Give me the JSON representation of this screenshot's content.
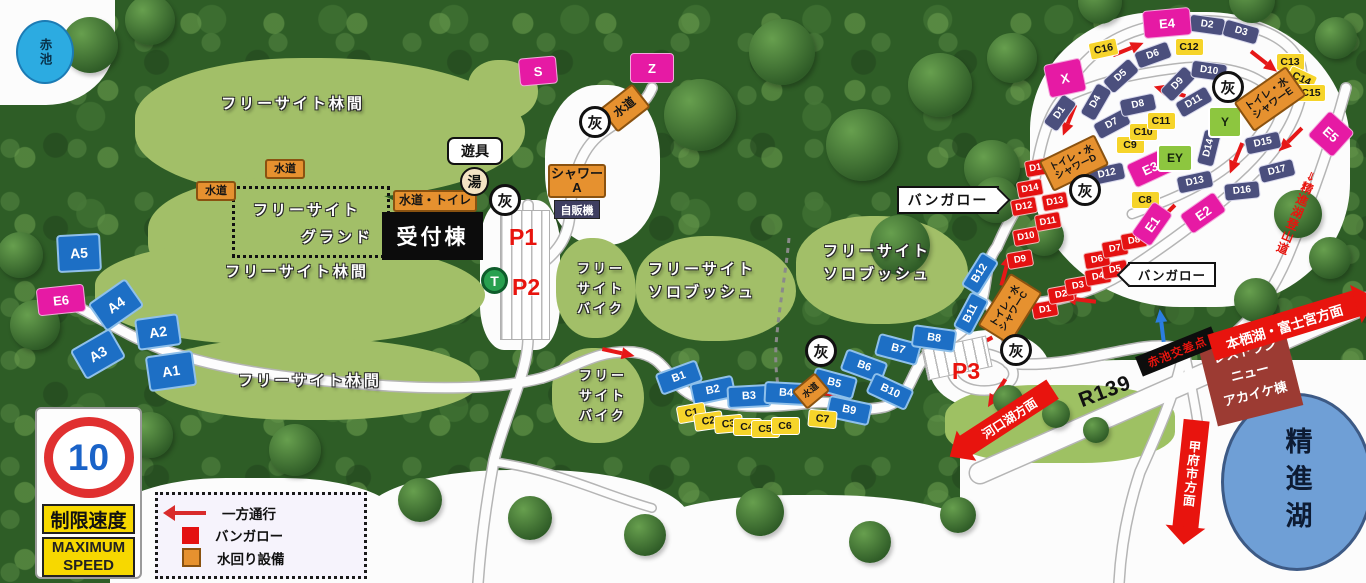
{
  "title": "キャンプ場マップ",
  "texts": {
    "reception": "受付棟",
    "playground": "遊具",
    "bath": "湯",
    "vending": "自販機",
    "p1": "P1",
    "p2": "P2",
    "p3": "P3",
    "t_pin": "T",
    "bungalow_pointer_right": "バンガロー",
    "bungalow_pointer_left": "バンガロー",
    "akaike_pond": "赤池",
    "shoji_lake": "精進湖",
    "intersection": "赤池交差点",
    "restaurant": [
      "レストラン",
      "ニュー",
      "アカイケ棟"
    ],
    "motosu_arrow": "本栖湖・富士宮方面",
    "kawaguchi_arrow": "河口湖方面",
    "kofu_arrow": "甲府市方面",
    "r139": "R139",
    "tozando": "⇒精進湖登山道",
    "grand_line1": "フリーサイト",
    "grand_line2": "グランド"
  },
  "legend": {
    "rows": [
      {
        "icon": "one-way-arrow",
        "label": "一方通行"
      },
      {
        "icon": "bungalow-square",
        "label": "バンガロー"
      },
      {
        "icon": "water-square",
        "label": "水回り設備"
      }
    ]
  },
  "speed_sign": {
    "number": "10",
    "jp": "制限速度",
    "en1": "MAXIMUM",
    "en2": "SPEED"
  },
  "colors": {
    "site_blue": "#1d6fc5",
    "site_navy": "#4b4f7d",
    "site_yellow": "#f6d42a",
    "bungalow_red": "#e41111",
    "site_magenta": "#e61aa4",
    "site_green": "#8dc63f",
    "water_orange": "#e6912f",
    "arrow_red": "#e61717",
    "arrow_blue": "#2b7de0",
    "forest_dark": "#2e5d26",
    "clearing_green": "#a2bf68",
    "lake_blue": "#6f9fd6",
    "pond_blue": "#2cabe1"
  },
  "map": {
    "ash_label": "灰",
    "clearings": [
      [
        1030,
        12,
        320,
        295,
        "#fcfcfc",
        "40% 45% 42% 47%"
      ],
      [
        930,
        330,
        120,
        80,
        "#fcfcfc",
        "50%"
      ],
      [
        480,
        200,
        80,
        150,
        "#fcfcfc",
        "30%"
      ],
      [
        545,
        85,
        115,
        160,
        "#fcfcfc",
        "45%"
      ],
      [
        0,
        0,
        115,
        105,
        "#fcfcfc",
        "0 0 60% 0"
      ],
      [
        110,
        478,
        290,
        105,
        "#fcfcfc",
        "40% 40% 0 0"
      ],
      [
        360,
        470,
        330,
        113,
        "#fcfcfc",
        "45% 45% 0 0"
      ],
      [
        640,
        495,
        340,
        88,
        "#fcfcfc",
        "45% 45% 0 0"
      ],
      [
        960,
        360,
        406,
        223,
        "#fcfcfc",
        "40% 0 0 0"
      ],
      [
        135,
        58,
        390,
        140,
        null,
        null
      ],
      [
        148,
        178,
        280,
        120,
        null,
        null
      ],
      [
        95,
        240,
        390,
        105,
        null,
        null
      ],
      [
        150,
        338,
        330,
        82,
        null,
        null
      ],
      [
        556,
        238,
        80,
        100,
        null,
        null
      ],
      [
        552,
        348,
        92,
        95,
        null,
        null
      ],
      [
        636,
        236,
        160,
        105,
        null,
        null
      ],
      [
        796,
        216,
        172,
        108,
        null,
        null
      ],
      [
        468,
        60,
        70,
        60,
        null,
        null
      ],
      [
        945,
        385,
        230,
        78,
        "#9ec163",
        "40%"
      ]
    ],
    "trees": [
      [
        90,
        45,
        56
      ],
      [
        150,
        20,
        50
      ],
      [
        20,
        255,
        46
      ],
      [
        35,
        325,
        50
      ],
      [
        150,
        435,
        46
      ],
      [
        295,
        450,
        52
      ],
      [
        420,
        500,
        44
      ],
      [
        530,
        518,
        44
      ],
      [
        645,
        535,
        42
      ],
      [
        760,
        512,
        48
      ],
      [
        870,
        542,
        42
      ],
      [
        958,
        515,
        36
      ],
      [
        700,
        115,
        72
      ],
      [
        782,
        52,
        66
      ],
      [
        862,
        145,
        72
      ],
      [
        940,
        85,
        64
      ],
      [
        992,
        168,
        56
      ],
      [
        900,
        245,
        60
      ],
      [
        1012,
        58,
        50
      ],
      [
        996,
        200,
        46
      ],
      [
        1044,
        236,
        40
      ],
      [
        1298,
        214,
        48
      ],
      [
        1330,
        258,
        42
      ],
      [
        1256,
        300,
        44
      ],
      [
        1100,
        2,
        44
      ],
      [
        1252,
        0,
        46
      ],
      [
        1336,
        38,
        42
      ],
      [
        1008,
        400,
        30
      ],
      [
        1056,
        414,
        28
      ],
      [
        1096,
        430,
        26
      ]
    ],
    "roads": [
      {
        "d": "M 48,295 C 90,308 120,335 170,352 C 230,372 300,380 390,386 C 440,389 500,389 542,378",
        "w": 9
      },
      {
        "d": "M 542,378 C 575,368 595,350 632,352 C 672,355 665,390 705,400 C 745,409 775,407 810,403 C 845,399 852,414 884,407 C 916,399 908,362 938,347 C 962,334 974,322 981,303 C 988,283 984,263 997,247",
        "w": 9
      },
      {
        "d": "M 528,205 L 528,338 C 528,372 505,415 494,460 C 487,498 481,540 478,583",
        "w": 9
      },
      {
        "d": "M 652,88 C 644,108 622,118 602,133 C 578,151 572,182 570,212 C 569,238 556,252 544,262",
        "w": 9
      },
      {
        "d": "M 997,247 C 1008,222 1018,203 1034,187 C 1038,152 1046,118 1062,99 C 1080,52 1124,28 1172,23 C 1232,15 1292,30 1301,68 C 1308,106 1282,148 1243,183 C 1203,219 1162,248 1122,274 C 1092,292 1062,300 1036,303",
        "w": 9
      },
      {
        "d": "M 1062,99 C 1092,84 1132,74 1172,69 C 1212,63 1252,70 1270,89 C 1281,108 1262,138 1232,163 C 1202,188 1162,203 1132,214",
        "w": 8
      },
      {
        "d": "M 938,347 C 962,352 992,349 1008,363 C 1024,379 1002,394 976,390 C 952,386 945,368 958,357",
        "w": 8
      },
      {
        "d": "M 1008,363 C 1052,368 1092,356 1132,349 C 1158,344 1172,346 1184,350 C 1176,392 1158,432 1140,472 C 1128,508 1121,545 1119,583",
        "w": 9
      },
      {
        "d": "M 1184,350 C 1191,382 1196,410 1200,437",
        "w": 8
      },
      {
        "d": "M 1346,88 C 1332,140 1312,198 1287,258 C 1267,304 1243,330 1212,351",
        "w": 9
      },
      {
        "d": "M 980,473 L 1366,303",
        "w": 20
      },
      {
        "d": "M 494,462 C 556,470 602,494 652,508",
        "w": 7
      },
      {
        "d": "M 983,300 C 996,312 1004,330 1008,348",
        "w": 7
      },
      {
        "d": "M 789,238 C 786,272 779,306 776,345 C 775,365 777,383 780,396",
        "w": 3,
        "dash": 1
      }
    ],
    "parking": [
      [
        500,
        210,
        48,
        128,
        0
      ],
      [
        924,
        342,
        64,
        30,
        -12
      ]
    ],
    "arrows": [
      [
        616,
        352,
        12
      ],
      [
        830,
        394,
        4
      ],
      [
        1005,
        272,
        -75
      ],
      [
        980,
        344,
        152
      ],
      [
        998,
        391,
        122
      ],
      [
        1082,
        300,
        187
      ],
      [
        1126,
        50,
        -22
      ],
      [
        1262,
        60,
        38
      ],
      [
        1292,
        138,
        135
      ],
      [
        1172,
        92,
        197
      ],
      [
        1070,
        118,
        112
      ],
      [
        1237,
        156,
        112
      ],
      [
        1165,
        215,
        135
      ],
      [
        1162,
        328,
        -97,
        1
      ]
    ],
    "sites": [
      {
        "id": "A1",
        "t": "A",
        "x": 169,
        "y": 369,
        "r": -8
      },
      {
        "id": "A2",
        "t": "A",
        "x": 156,
        "y": 330,
        "r": -8,
        "w": 40,
        "h": 28
      },
      {
        "id": "A3",
        "t": "A",
        "x": 96,
        "y": 352,
        "r": -30,
        "w": 42,
        "h": 30
      },
      {
        "id": "A4",
        "t": "A",
        "x": 114,
        "y": 303,
        "r": -35,
        "w": 42,
        "h": 30
      },
      {
        "id": "A5",
        "t": "A",
        "x": 77,
        "y": 251,
        "r": -3,
        "w": 40,
        "h": 34
      },
      {
        "id": "E6",
        "t": "M",
        "x": 60,
        "y": 299,
        "r": -6,
        "w": 46,
        "h": 26
      },
      {
        "id": "B1",
        "t": "B",
        "x": 677,
        "y": 375,
        "r": -20
      },
      {
        "id": "B2",
        "t": "B",
        "x": 711,
        "y": 388,
        "r": -12
      },
      {
        "id": "B3",
        "t": "B",
        "x": 747,
        "y": 394,
        "r": -3
      },
      {
        "id": "B4",
        "t": "B",
        "x": 784,
        "y": 391,
        "r": 3
      },
      {
        "id": "B5",
        "t": "B",
        "x": 832,
        "y": 381,
        "r": 15
      },
      {
        "id": "B6",
        "t": "B",
        "x": 862,
        "y": 364,
        "r": 20
      },
      {
        "id": "B7",
        "t": "B",
        "x": 896,
        "y": 347,
        "r": 15
      },
      {
        "id": "B8",
        "t": "B",
        "x": 932,
        "y": 336,
        "r": 8
      },
      {
        "id": "B9",
        "t": "B",
        "x": 847,
        "y": 408,
        "r": 12
      },
      {
        "id": "B10",
        "t": "B",
        "x": 888,
        "y": 389,
        "r": 25
      },
      {
        "id": "B11",
        "t": "B",
        "x": 969,
        "y": 311,
        "r": -62,
        "w": 36,
        "h": 17
      },
      {
        "id": "B12",
        "t": "B",
        "x": 978,
        "y": 271,
        "r": -58,
        "w": 36,
        "h": 17
      },
      {
        "id": "C1",
        "t": "C",
        "x": 690,
        "y": 412,
        "r": -10
      },
      {
        "id": "C2",
        "t": "C",
        "x": 707,
        "y": 420,
        "r": -8
      },
      {
        "id": "C3",
        "t": "C",
        "x": 727,
        "y": 423,
        "r": -5
      },
      {
        "id": "C4",
        "t": "C",
        "x": 746,
        "y": 426,
        "r": 0
      },
      {
        "id": "C5",
        "t": "C",
        "x": 764,
        "y": 428,
        "r": 0
      },
      {
        "id": "C6",
        "t": "C",
        "x": 784,
        "y": 425,
        "r": 0
      },
      {
        "id": "C7",
        "t": "C",
        "x": 821,
        "y": 418,
        "r": 5
      },
      {
        "id": "C8",
        "t": "C",
        "x": 1144,
        "y": 199,
        "r": 0
      },
      {
        "id": "C9",
        "t": "C",
        "x": 1129,
        "y": 144,
        "r": 0
      },
      {
        "id": "C10",
        "t": "C",
        "x": 1142,
        "y": 131,
        "r": 0
      },
      {
        "id": "C11",
        "t": "C",
        "x": 1160,
        "y": 120,
        "r": 0
      },
      {
        "id": "C12",
        "t": "C",
        "x": 1188,
        "y": 46,
        "r": 0
      },
      {
        "id": "C13",
        "t": "C",
        "x": 1289,
        "y": 61,
        "r": 0
      },
      {
        "id": "C14",
        "t": "C",
        "x": 1300,
        "y": 78,
        "r": 25
      },
      {
        "id": "C15",
        "t": "C",
        "x": 1310,
        "y": 92,
        "r": 0
      },
      {
        "id": "C16",
        "t": "C",
        "x": 1102,
        "y": 48,
        "r": -12
      },
      {
        "id": "D1",
        "t": "N",
        "x": 1059,
        "y": 112,
        "r": -55
      },
      {
        "id": "D2",
        "t": "N",
        "x": 1206,
        "y": 24,
        "r": 8
      },
      {
        "id": "D3",
        "t": "N",
        "x": 1240,
        "y": 31,
        "r": 16
      },
      {
        "id": "D4",
        "t": "N",
        "x": 1095,
        "y": 101,
        "r": -60
      },
      {
        "id": "D5",
        "t": "N",
        "x": 1120,
        "y": 75,
        "r": -42
      },
      {
        "id": "D6",
        "t": "N",
        "x": 1152,
        "y": 54,
        "r": -20
      },
      {
        "id": "D7",
        "t": "N",
        "x": 1111,
        "y": 123,
        "r": -28
      },
      {
        "id": "D8",
        "t": "N",
        "x": 1137,
        "y": 104,
        "r": -12
      },
      {
        "id": "D9",
        "t": "N",
        "x": 1177,
        "y": 83,
        "r": -46
      },
      {
        "id": "D10",
        "t": "N",
        "x": 1208,
        "y": 70,
        "r": 8
      },
      {
        "id": "D11",
        "t": "N",
        "x": 1193,
        "y": 101,
        "r": -30
      },
      {
        "id": "D12",
        "t": "N",
        "x": 1106,
        "y": 173,
        "r": -12
      },
      {
        "id": "D13",
        "t": "N",
        "x": 1194,
        "y": 181,
        "r": -12
      },
      {
        "id": "D14",
        "t": "N",
        "x": 1208,
        "y": 147,
        "r": -76
      },
      {
        "id": "D15",
        "t": "N",
        "x": 1262,
        "y": 142,
        "r": -12
      },
      {
        "id": "D16",
        "t": "N",
        "x": 1241,
        "y": 190,
        "r": -6
      },
      {
        "id": "D17",
        "t": "N",
        "x": 1276,
        "y": 170,
        "r": -14
      },
      {
        "id": "D1",
        "t": "R",
        "x": 1044,
        "y": 308,
        "r": -10
      },
      {
        "id": "D2",
        "t": "R",
        "x": 1060,
        "y": 293,
        "r": -10
      },
      {
        "id": "D3",
        "t": "R",
        "x": 1077,
        "y": 284,
        "r": -10
      },
      {
        "id": "D4",
        "t": "R",
        "x": 1097,
        "y": 275,
        "r": -10
      },
      {
        "id": "D5",
        "t": "R",
        "x": 1114,
        "y": 268,
        "r": -10
      },
      {
        "id": "D6",
        "t": "R",
        "x": 1096,
        "y": 258,
        "r": -10
      },
      {
        "id": "D7",
        "t": "R",
        "x": 1114,
        "y": 247,
        "r": -10
      },
      {
        "id": "D8",
        "t": "R",
        "x": 1133,
        "y": 239,
        "r": -10
      },
      {
        "id": "D9",
        "t": "R",
        "x": 1019,
        "y": 258,
        "r": -10
      },
      {
        "id": "D10",
        "t": "R",
        "x": 1025,
        "y": 235,
        "r": -10
      },
      {
        "id": "D11",
        "t": "R",
        "x": 1047,
        "y": 220,
        "r": -10
      },
      {
        "id": "D12",
        "t": "R",
        "x": 1023,
        "y": 205,
        "r": -10
      },
      {
        "id": "D13",
        "t": "R",
        "x": 1054,
        "y": 200,
        "r": -10
      },
      {
        "id": "D14",
        "t": "R",
        "x": 1029,
        "y": 187,
        "r": -10
      },
      {
        "id": "D15",
        "t": "R",
        "x": 1037,
        "y": 166,
        "r": -10
      },
      {
        "id": "S",
        "t": "M",
        "x": 537,
        "y": 70,
        "r": -5,
        "w": 36,
        "h": 26
      },
      {
        "id": "Z",
        "t": "M",
        "x": 651,
        "y": 67,
        "r": 0,
        "w": 42,
        "h": 28
      },
      {
        "id": "X",
        "t": "M",
        "x": 1064,
        "y": 77,
        "r": -12,
        "w": 36,
        "h": 32
      },
      {
        "id": "E1",
        "t": "M",
        "x": 1151,
        "y": 223,
        "r": -55,
        "w": 38,
        "h": 22
      },
      {
        "id": "E2",
        "t": "M",
        "x": 1202,
        "y": 212,
        "r": -35,
        "w": 40,
        "h": 22
      },
      {
        "id": "E3",
        "t": "M",
        "x": 1149,
        "y": 167,
        "r": -25,
        "w": 40,
        "h": 24
      },
      {
        "id": "E4",
        "t": "M",
        "x": 1166,
        "y": 22,
        "r": -5,
        "w": 46,
        "h": 26
      },
      {
        "id": "E5",
        "t": "M",
        "x": 1330,
        "y": 133,
        "r": 42,
        "w": 32,
        "h": 32
      },
      {
        "id": "Y",
        "t": "G",
        "x": 1223,
        "y": 120,
        "r": 0,
        "w": 30,
        "h": 28
      },
      {
        "id": "EY",
        "t": "G",
        "x": 1173,
        "y": 156,
        "r": 0,
        "w": 32,
        "h": 24
      }
    ],
    "water": [
      {
        "lines": [
          "水道"
        ],
        "x": 283,
        "y": 167,
        "w": 36,
        "h": 16,
        "r": 0,
        "f": 11
      },
      {
        "lines": [
          "水道"
        ],
        "x": 214,
        "y": 189,
        "w": 36,
        "h": 16,
        "r": 0,
        "f": 11
      },
      {
        "lines": [
          "水道"
        ],
        "x": 623,
        "y": 106,
        "w": 38,
        "h": 26,
        "r": -38,
        "f": 12
      },
      {
        "lines": [
          "水道"
        ],
        "x": 809,
        "y": 389,
        "w": 26,
        "h": 20,
        "r": -40,
        "f": 9
      },
      {
        "lines": [
          "水道・トイレ"
        ],
        "x": 433,
        "y": 199,
        "w": 80,
        "h": 18,
        "r": 0,
        "f": 12
      },
      {
        "lines": [
          "シャワーA"
        ],
        "x": 575,
        "y": 179,
        "w": 54,
        "h": 30,
        "r": 0,
        "f": 13
      },
      {
        "lines": [
          "トイレ・水",
          "シャワーC"
        ],
        "x": 1008,
        "y": 307,
        "w": 58,
        "h": 34,
        "r": -58,
        "f": 9.5
      },
      {
        "lines": [
          "トイレ・水",
          "シャワーD"
        ],
        "x": 1072,
        "y": 161,
        "w": 58,
        "h": 30,
        "r": -26,
        "f": 9.5
      },
      {
        "lines": [
          "トイレ・水",
          "シャワーE"
        ],
        "x": 1268,
        "y": 97,
        "w": 60,
        "h": 32,
        "r": -35,
        "f": 10
      }
    ],
    "ash": [
      [
        595,
        122
      ],
      [
        505,
        200
      ],
      [
        821,
        351
      ],
      [
        1016,
        350
      ],
      [
        1085,
        190
      ],
      [
        1228,
        87
      ]
    ],
    "area_labels": [
      {
        "lines": [
          "フリーサイト林間"
        ],
        "x": 293,
        "y": 104,
        "f": 15
      },
      {
        "lines": [
          "フリーサイト林間"
        ],
        "x": 297,
        "y": 272,
        "f": 15
      },
      {
        "lines": [
          "フリーサイト林間"
        ],
        "x": 310,
        "y": 381,
        "f": 15
      },
      {
        "lines": [
          "フリー",
          "サイト",
          "バイク"
        ],
        "x": 601,
        "y": 289,
        "f": 13
      },
      {
        "lines": [
          "フリー",
          "サイト",
          "バイク"
        ],
        "x": 603,
        "y": 396,
        "f": 13
      },
      {
        "lines": [
          "フリーサイト",
          "ソロブッシュ"
        ],
        "x": 702,
        "y": 281,
        "f": 15
      },
      {
        "lines": [
          "フリーサイト",
          "ソロブッシュ"
        ],
        "x": 877,
        "y": 263,
        "f": 15
      }
    ]
  }
}
